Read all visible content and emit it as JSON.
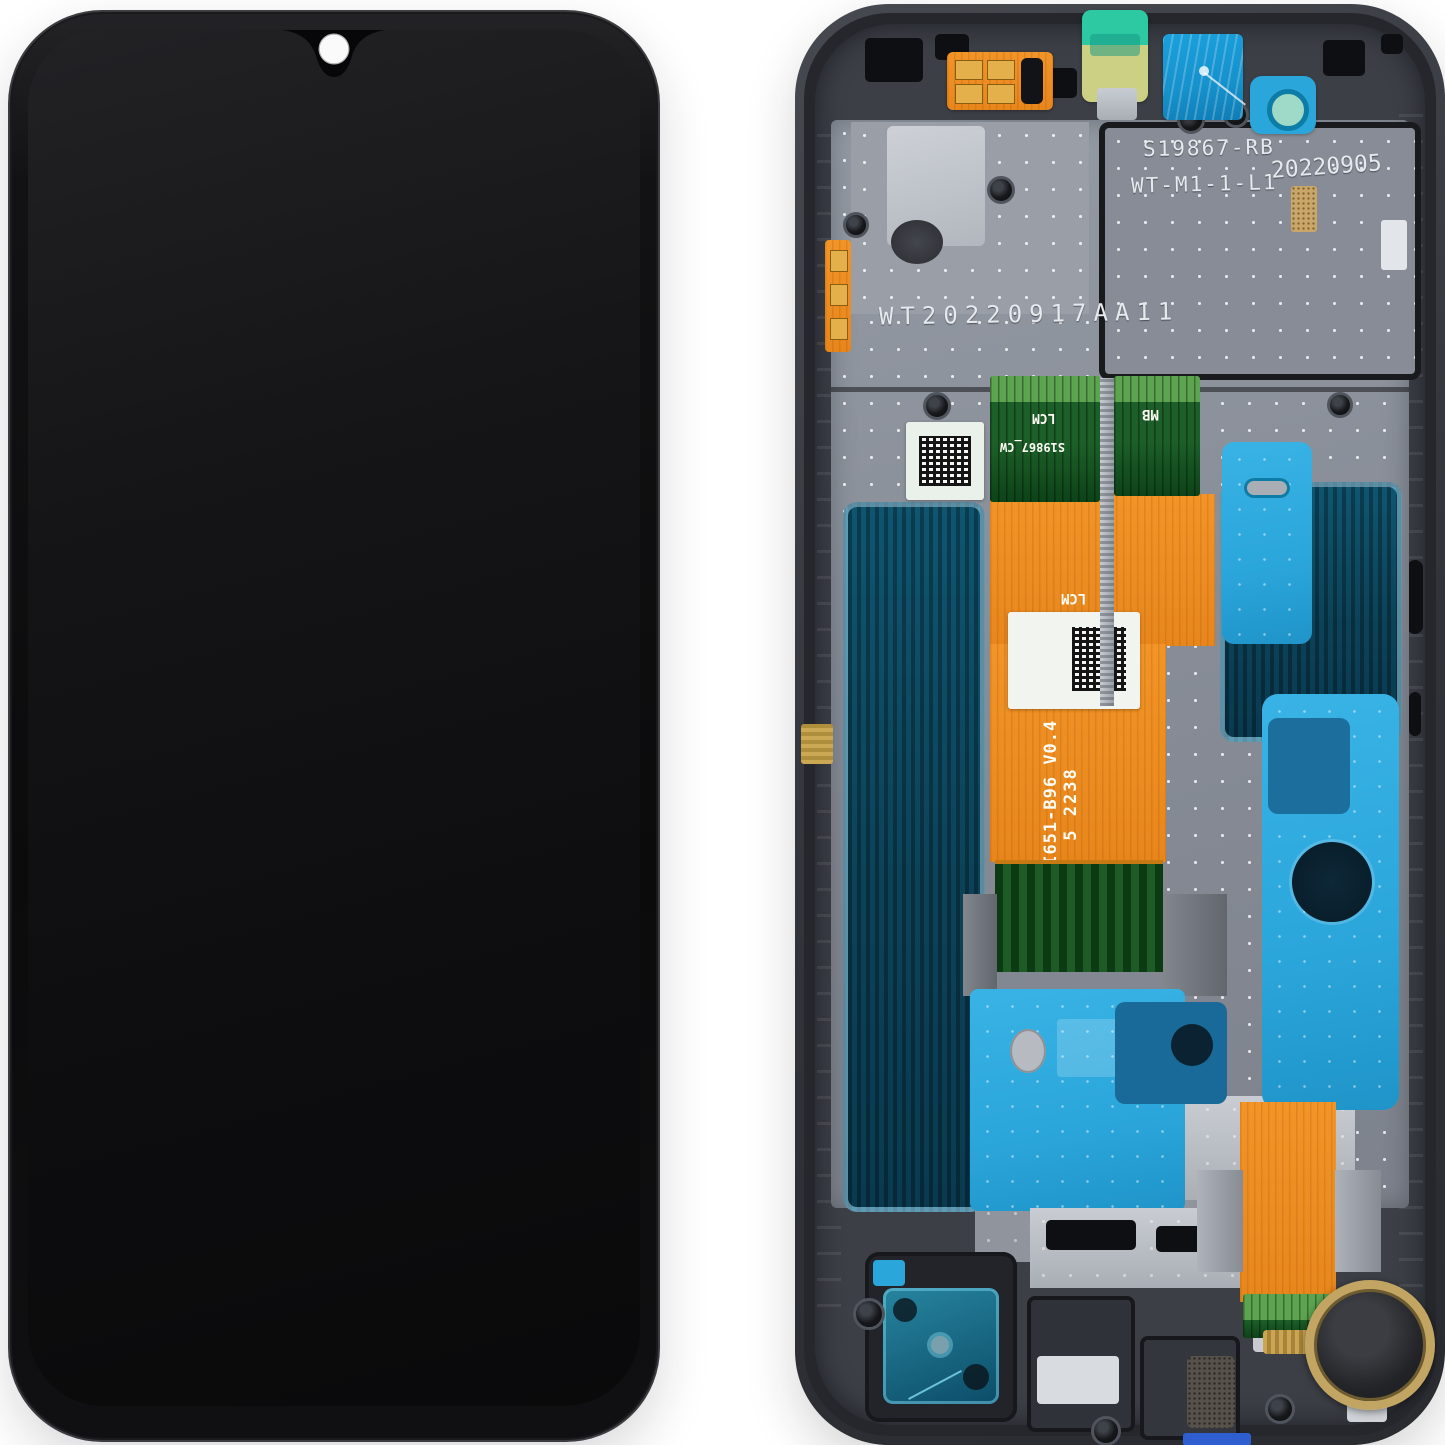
{
  "back_markings": {
    "plate_line1": "S19867-RB",
    "plate_line2": "WT-M1-1-L1",
    "plate_date": "20220905",
    "frame_serial": "WT20220917AA11"
  },
  "flex_labels": {
    "lcm_upper": "LCM",
    "cable_code": "S19867_CW",
    "mainboard_tag": "MB",
    "lcm_mid": "LCM",
    "part_number": "SKI651-B96  V0.4",
    "batch_code": "5 2238"
  },
  "colors": {
    "background": "#ffffff",
    "phone_body": "#0b0b0c",
    "screen_dark": "#121214",
    "camera_dot": "#fafafa",
    "frame": "#34373d",
    "metal_plate": "#8a8f99",
    "bright_plate": "#c3c7ce",
    "orange_flex": "#e8861c",
    "green_flex": "#1c5f28",
    "teal_panel": "#0c4258",
    "blue_adhesive": "#2ba6db",
    "sticker_mint": "#2cc9a2",
    "sticker_khaki": "#ccd084",
    "sticker_blue": "#1691cc",
    "etched_text": "#e6e9ee",
    "motor_ring": "#c3a563"
  }
}
